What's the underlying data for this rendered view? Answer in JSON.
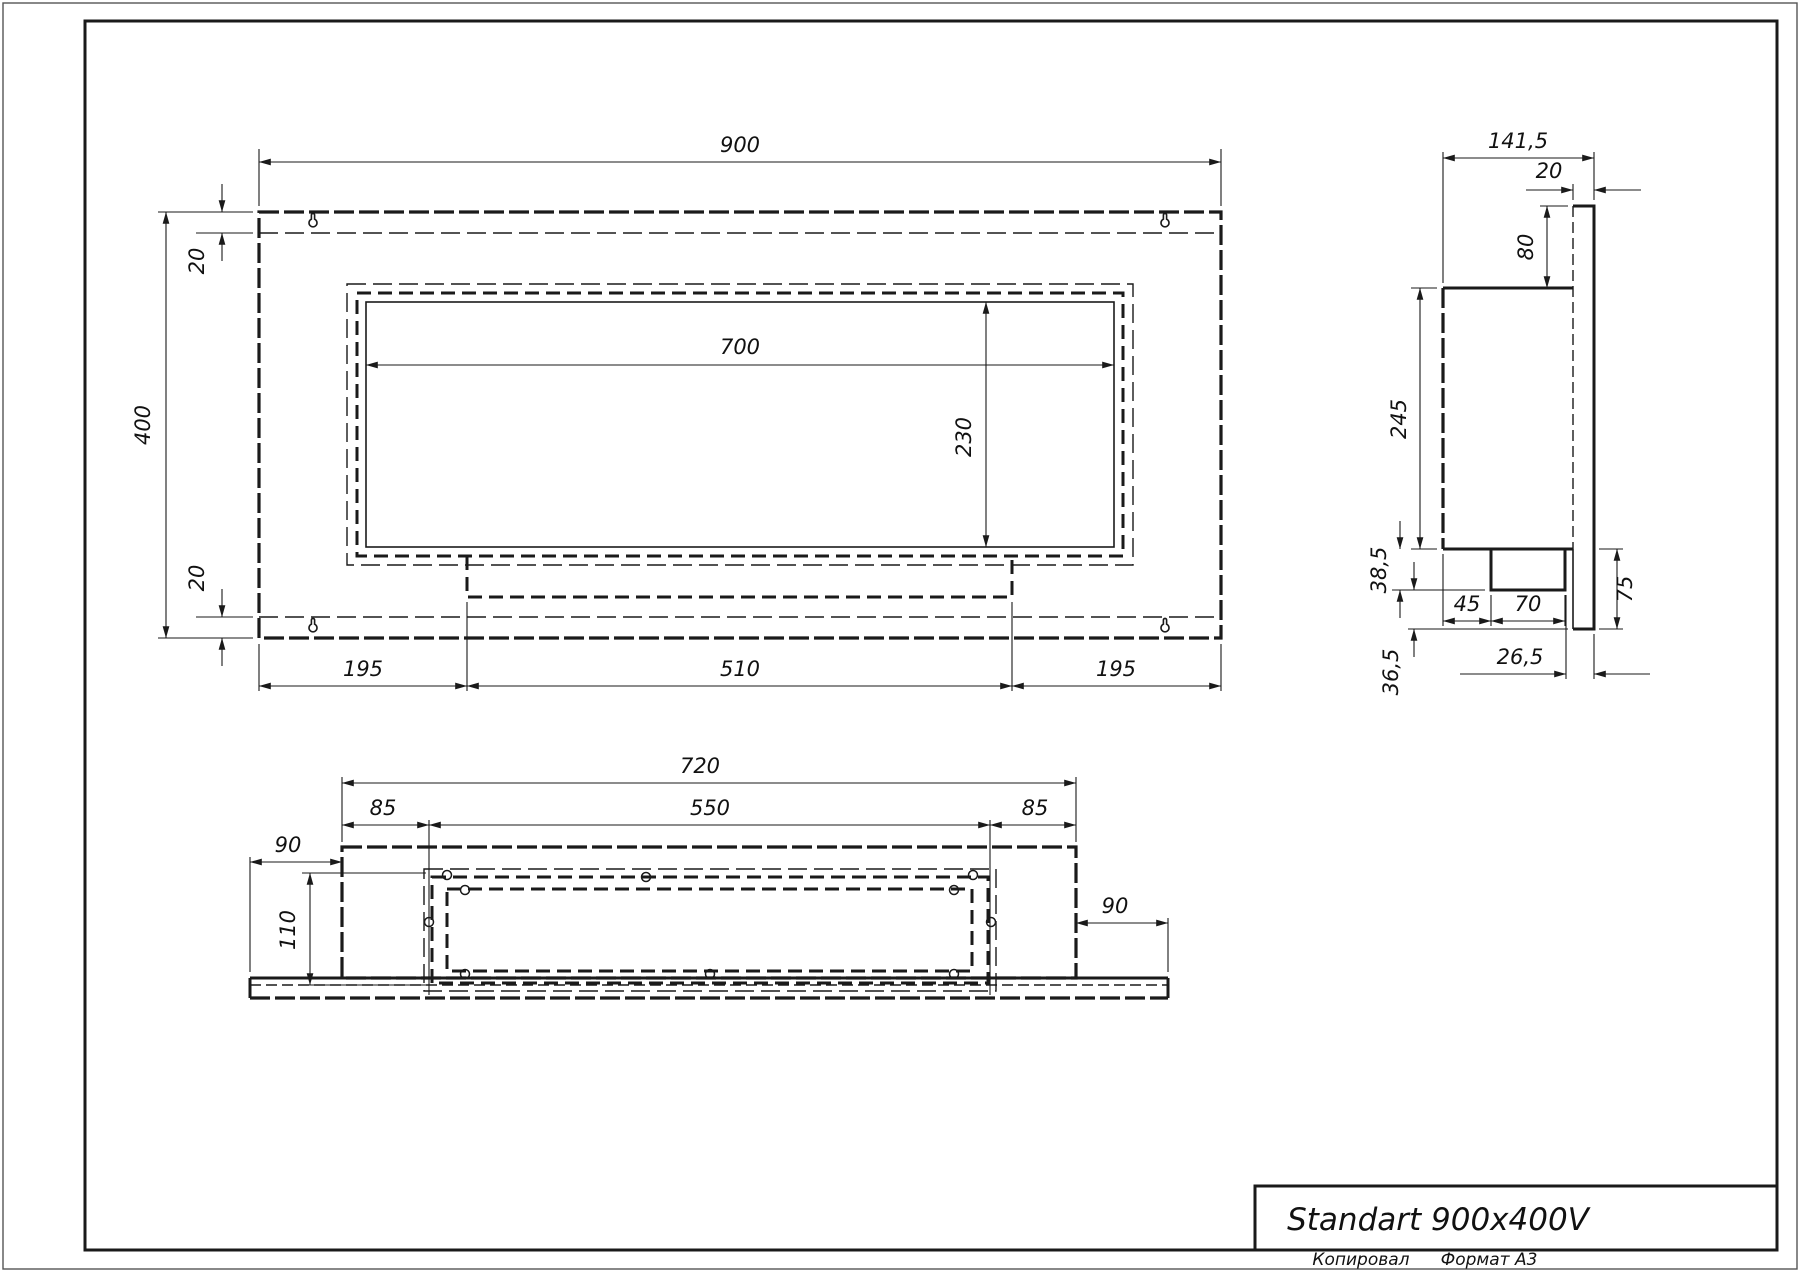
{
  "title_block": {
    "name": "Standart 900x400V"
  },
  "footer": {
    "copied": "Копировал",
    "format": "Формат А3"
  },
  "front_view": {
    "width": "900",
    "height": "400",
    "flange_top": "20",
    "flange_bottom": "20",
    "opening_width": "700",
    "opening_height": "230",
    "left_margin": "195",
    "burner_width": "510",
    "right_margin": "195"
  },
  "side_view": {
    "depth": "141,5",
    "panel_thickness": "20",
    "top_offset": "80",
    "body_height": "245",
    "tray_height": "38,5",
    "notch_offset": "45",
    "notch_width": "70",
    "lower_height": "75",
    "bottom_gap": "36,5",
    "tray_inset": "26,5"
  },
  "bottom_view": {
    "body_width": "720",
    "tray_width": "550",
    "tray_inset_left": "85",
    "tray_inset_right": "85",
    "side_margin_left": "90",
    "side_margin_right": "90",
    "tray_depth": "110"
  }
}
